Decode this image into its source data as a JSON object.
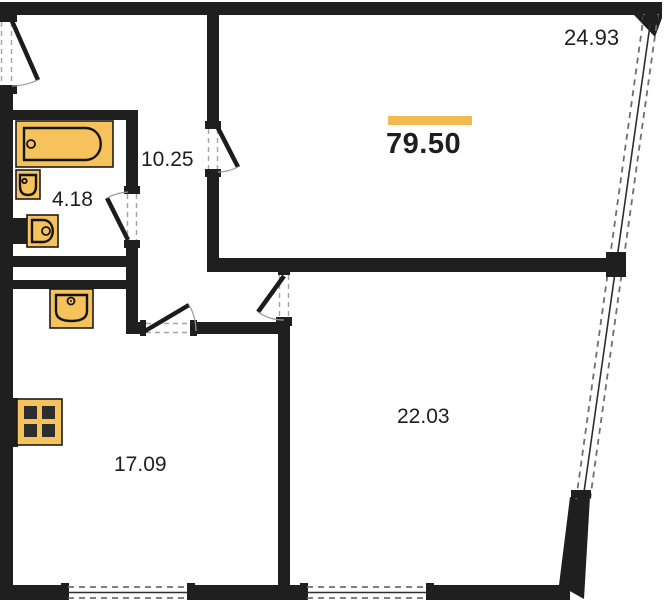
{
  "areas": {
    "total": "79.50",
    "room_top": "24.93",
    "hallway": "10.25",
    "bathroom": "4.18",
    "room_bottom_right": "22.03",
    "room_bottom_left": "17.09"
  },
  "colors": {
    "wall": "#1f1f1f",
    "fixture_fill": "#F6C25C",
    "fixture_outline": "#141414",
    "accent_bar": "#F2BB52",
    "background": "#ffffff"
  },
  "icons": [
    "bathtub-icon",
    "hand-basin-icon",
    "toilet-icon",
    "kitchen-sink-icon",
    "stove-icon"
  ]
}
